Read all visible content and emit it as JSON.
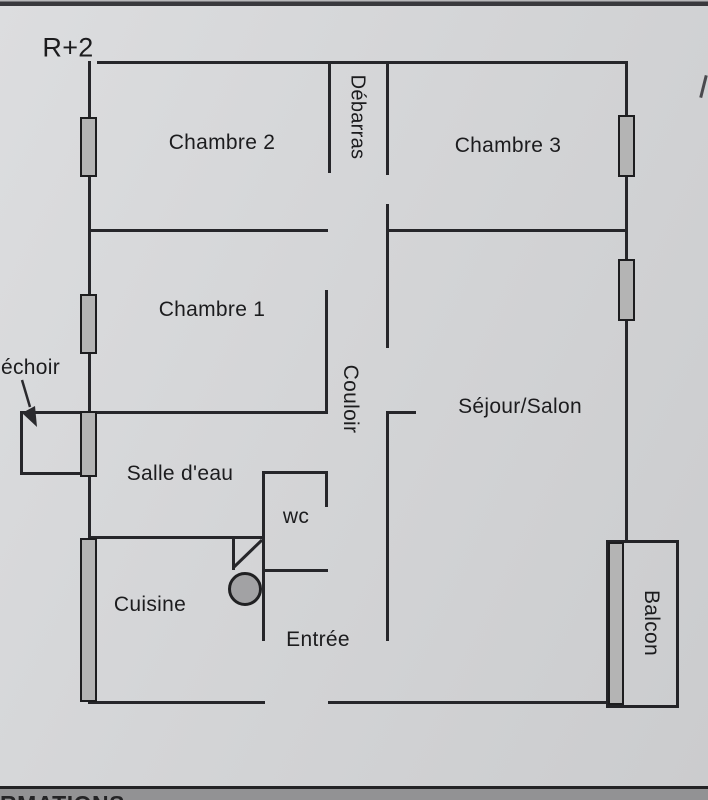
{
  "page": {
    "floor_label": "R+2",
    "bottom_band_text": "RMATIONS"
  },
  "plan": {
    "rooms": [
      {
        "id": "chambre2",
        "label": "Chambre 2",
        "orientation": "horizontal"
      },
      {
        "id": "debarras",
        "label": "Débarras",
        "orientation": "vertical"
      },
      {
        "id": "chambre3",
        "label": "Chambre 3",
        "orientation": "horizontal"
      },
      {
        "id": "chambre1",
        "label": "Chambre 1",
        "orientation": "horizontal"
      },
      {
        "id": "couloir",
        "label": "Couloir",
        "orientation": "vertical"
      },
      {
        "id": "sejour",
        "label": "Séjour/Salon",
        "orientation": "horizontal"
      },
      {
        "id": "sechoir",
        "label": "échoir",
        "orientation": "horizontal"
      },
      {
        "id": "salledeau",
        "label": "Salle d'eau",
        "orientation": "horizontal"
      },
      {
        "id": "wc",
        "label": "wc",
        "orientation": "horizontal"
      },
      {
        "id": "cuisine",
        "label": "Cuisine",
        "orientation": "horizontal"
      },
      {
        "id": "entree",
        "label": "Entrée",
        "orientation": "horizontal"
      },
      {
        "id": "balcon",
        "label": "Balcon",
        "orientation": "vertical"
      }
    ],
    "colors": {
      "wall": "#26262a",
      "window_fill": "#b4b4b4",
      "paper": "#d4d5d7",
      "bottom_band": "#929294",
      "text": "#1c1c1e"
    }
  }
}
